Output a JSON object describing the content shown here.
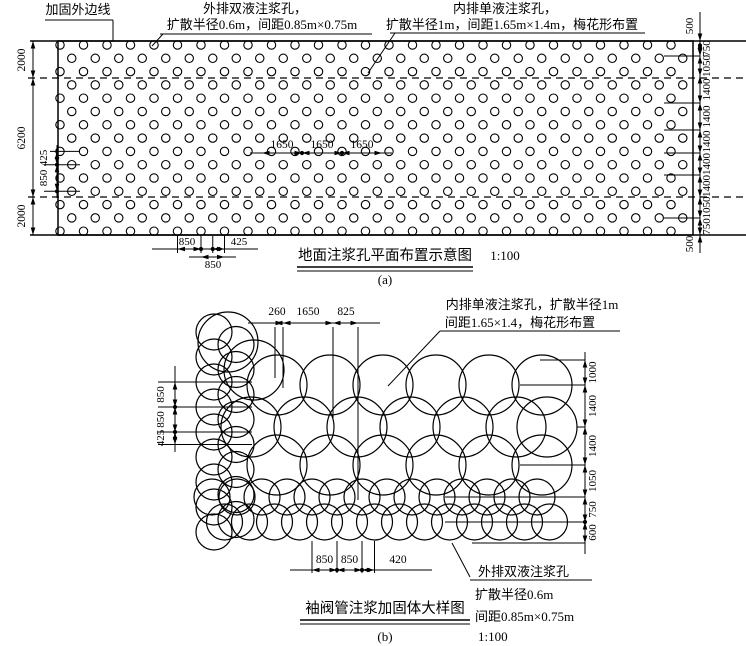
{
  "page": {
    "background": "#ffffff",
    "line_color": "#000000"
  },
  "figure_a": {
    "boundary_label": "加固外边线",
    "outer_label_line1": "外排双液注浆孔，",
    "outer_label_line2": "扩散半径0.6m，间距0.85m×0.75m",
    "inner_label_line1": "内排单液注浆孔，",
    "inner_label_line2": "扩散半径1m，间距1.65m×1.4m，梅花形布置",
    "title": "地面注浆孔平面布置示意图",
    "scale": "1:100",
    "subfig": "(a)",
    "dim_left": [
      "2000",
      "6200",
      "2000"
    ],
    "dim_right_top": "500",
    "dim_right": [
      "750",
      "1050",
      "1400",
      "1400",
      "1400",
      "1400",
      "1400",
      "1050",
      "750"
    ],
    "dim_right_bottom": "500",
    "dim_middle": [
      "1650",
      "1650",
      "1650"
    ],
    "dim_inner_left": [
      "425",
      "850"
    ],
    "dim_bottom_upper": [
      "850",
      "425"
    ],
    "dim_bottom_lower": "850",
    "grid": {
      "rows": 15,
      "row0_y": 45,
      "row_dy": 13.3,
      "x0": 60,
      "dx": 23.5,
      "x_end": 691,
      "stagger": 11.75,
      "radius": 4.2
    },
    "rect": {
      "x": 58,
      "y": 41,
      "w": 635,
      "h": 194
    },
    "dashed_y": [
      78,
      197
    ]
  },
  "figure_b": {
    "inner_label_line1": "内排单液注浆孔，扩散半径1m",
    "inner_label_line2": "间距1.65×1.4，梅花形布置",
    "outer_label_line1": "外排双液注浆孔",
    "outer_label_line2": "扩散半径0.6m",
    "outer_label_line3": "间距0.85m×0.75m",
    "outer_label_scale": "1:100",
    "title": "袖阀管注浆加固体大样图",
    "subfig": "(b)",
    "dim_top": [
      "260",
      "1650",
      "825"
    ],
    "dim_left": [
      "850",
      "850",
      "425"
    ],
    "dim_right": [
      "1000",
      "1400",
      "1400",
      "1050",
      "750",
      "600"
    ],
    "dim_bottom": [
      "850",
      "850",
      "420"
    ],
    "big_radius": 30,
    "small_radius": 18,
    "big_rows": [
      {
        "y": 385,
        "x": [
          277,
          330,
          383,
          436,
          489,
          542
        ]
      },
      {
        "y": 427,
        "x": [
          251,
          304,
          357,
          410,
          463,
          516,
          547
        ]
      },
      {
        "y": 465,
        "x": [
          277,
          330,
          383,
          436,
          489,
          542
        ]
      }
    ],
    "corner_circles": [
      [
        228,
        342
      ],
      [
        254,
        370
      ]
    ],
    "left_cols": [
      {
        "x": 214,
        "y0": 332,
        "dy": 25,
        "n": 9
      },
      {
        "x": 236,
        "y0": 344.5,
        "dy": 25,
        "n": 8
      }
    ],
    "bottom_rows": [
      {
        "y": 497,
        "x0": 212,
        "dx": 25,
        "n": 14
      },
      {
        "y": 522,
        "x0": 224.5,
        "dx": 25,
        "n": 14
      }
    ]
  }
}
